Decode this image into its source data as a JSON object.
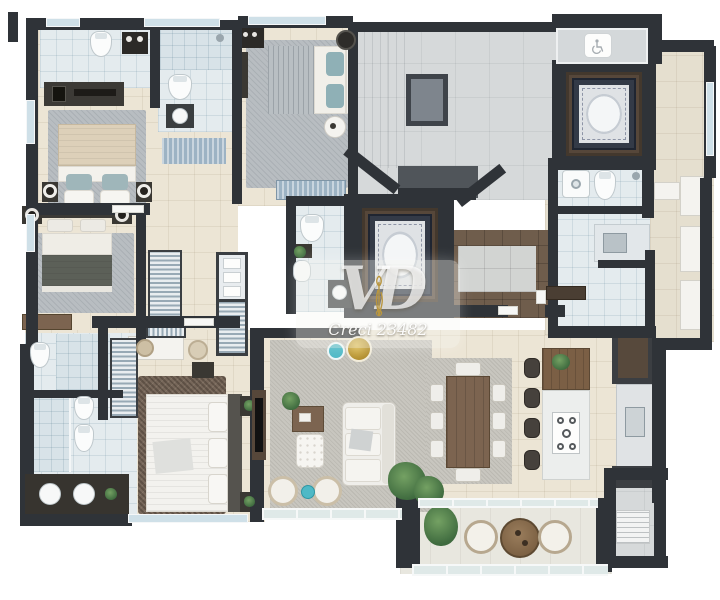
{
  "watermark": {
    "logo": "VD",
    "license": "Creci 23482"
  },
  "icons": {
    "accessible": "wheelchair-icon"
  },
  "palette": {
    "wall": "#2f3338",
    "wall_brown": "#56473a",
    "floor_cream": "#ece5d5",
    "bath_tile": "#e4ebee",
    "hall_concrete": "#d6d9da",
    "wood": "#7c6450",
    "rug_gray": "#b8bdc1",
    "shag_brown": "#77675a",
    "sofa_white": "#f0efeb",
    "teal": "#4fb9c6",
    "gold": "#c9a83a",
    "plant_green": "#4e7d4e",
    "glass_blue": "#cfe0e8",
    "carpet_navy": "#333a47"
  },
  "apartment": {
    "rooms": [
      {
        "name": "bathroom-top-left",
        "furniture": [
          "toilet",
          "water-heater",
          "vanity-sink",
          "shower"
        ]
      },
      {
        "name": "bathroom-top-center",
        "furniture": [
          "shower",
          "toilet",
          "vanity-round-sink"
        ]
      },
      {
        "name": "bedroom-1",
        "furniture": [
          "double-bed",
          "nightstand-lamps",
          "area-rug"
        ]
      },
      {
        "name": "bedroom-2",
        "furniture": [
          "double-bed",
          "speaker-side-tables",
          "dresser",
          "area-rug"
        ]
      },
      {
        "name": "suite-2-bedroom",
        "furniture": [
          "double-bed",
          "tv-panel",
          "wardrobe",
          "side-tables",
          "bench",
          "area-rug"
        ]
      },
      {
        "name": "corridor-closet",
        "furniture": [
          "hanging-wardrobe",
          "shelf-wardrobe",
          "laundry-basket",
          "blue-runner-rug"
        ]
      },
      {
        "name": "bathroom-center",
        "furniture": [
          "toilet",
          "vanity-sink",
          "shower",
          "plant"
        ]
      },
      {
        "name": "master-closet",
        "furniture": [
          "hanging-wardrobe",
          "pouf",
          "dresser"
        ]
      },
      {
        "name": "master-bathroom",
        "furniture": [
          "toilet",
          "bidet",
          "walk-in-shower",
          "double-vanity-sinks",
          "plant"
        ]
      },
      {
        "name": "master-bedroom",
        "furniture": [
          "king-bed",
          "nightstand-plants",
          "shag-rug"
        ]
      },
      {
        "name": "living-room",
        "furniture": [
          "sofa",
          "tv-panel",
          "wood-coffee-table",
          "tufted-ottoman",
          "rattan-poufs",
          "teal-side-table",
          "gold-side-table",
          "plants",
          "area-rug"
        ]
      },
      {
        "name": "dining-room",
        "furniture": [
          "dining-table",
          "eight-chairs",
          "plant"
        ]
      },
      {
        "name": "kitchen",
        "furniture": [
          "island-with-cooktop",
          "four-stools",
          "counter-sink",
          "tall-cabinet",
          "flower-vase"
        ]
      },
      {
        "name": "entry-foyer",
        "furniture": [
          "console-table",
          "floor-mat"
        ]
      },
      {
        "name": "service-area",
        "furniture": [
          "laundry-counter",
          "washer",
          "toilet",
          "shower"
        ]
      },
      {
        "name": "tech-balcony",
        "furniture": [
          "ac-unit",
          "ac-unit",
          "ac-unit"
        ]
      },
      {
        "name": "balcony",
        "furniture": [
          "round-table",
          "two-armchairs",
          "plant",
          "glass-railing"
        ]
      }
    ],
    "common_areas": [
      {
        "name": "stair-hall",
        "features": [
          "stair-void",
          "landing",
          "diagonal-walls"
        ]
      },
      {
        "name": "elevator-1",
        "features": [
          "ornate-carpet"
        ]
      },
      {
        "name": "elevator-2",
        "features": [
          "ornate-carpet"
        ]
      },
      {
        "name": "accessible-waiting-area",
        "features": [
          "wheelchair-icon"
        ]
      }
    ]
  }
}
